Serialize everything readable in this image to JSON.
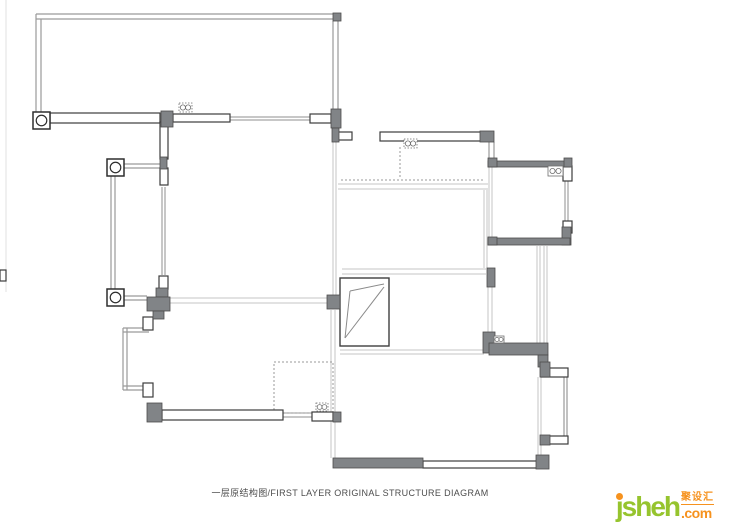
{
  "title": {
    "text": "一层原结构图/FIRST LAYER ORIGINAL STRUCTURE DIAGRAM"
  },
  "logo": {
    "main": "jsheh",
    "cn": "聚设汇",
    "com": ".com",
    "green": "#96c42e",
    "orange": "#f6921e"
  },
  "plan": {
    "colors": {
      "wall_line": "#9a9a9a",
      "glazing": "#8f8f8f",
      "light_line": "#c4c4c4",
      "dotted": "#9a9a9a",
      "artifact": "#e0e0e0",
      "white_fill": "#ffffff",
      "white_stroke": "#3c3c3c",
      "dark_fill": "#818487",
      "dark_stroke": "#4c4c4c",
      "symbol_stroke": "#6f6f6f",
      "column_stroke": "#2e2e2e",
      "stair_stroke": "#3f3f3f",
      "stair_line": "#8a8a8a"
    },
    "line_groups": [
      {
        "name": "structural-wall-line",
        "color": "wall_line",
        "width": 1.2,
        "segments": [
          [
            36,
            14,
            339,
            14
          ],
          [
            36,
            19,
            339,
            19
          ],
          [
            36,
            14,
            36,
            113
          ],
          [
            41,
            19,
            41,
            113
          ],
          [
            333,
            21,
            333,
            110
          ],
          [
            338,
            21,
            338,
            110
          ],
          [
            124,
            164,
            160,
            164
          ],
          [
            124,
            168,
            160,
            168
          ],
          [
            111,
            176,
            111,
            289
          ],
          [
            115,
            176,
            115,
            289
          ],
          [
            124,
            296,
            147,
            296
          ],
          [
            124,
            300,
            147,
            300
          ],
          [
            123,
            328,
            123,
            390
          ],
          [
            127,
            328,
            127,
            390
          ],
          [
            123,
            328,
            149,
            328
          ],
          [
            123,
            332,
            149,
            332
          ],
          [
            123,
            386,
            149,
            386
          ],
          [
            123,
            390,
            149,
            390
          ],
          [
            489,
            142,
            489,
            158
          ],
          [
            494,
            142,
            494,
            158
          ],
          [
            564,
            377,
            564,
            436
          ],
          [
            567,
            377,
            567,
            436
          ]
        ]
      },
      {
        "name": "window-glazing-line",
        "color": "glazing",
        "width": 1,
        "segments": [
          [
            230,
            117,
            310,
            117
          ],
          [
            230,
            120,
            310,
            120
          ],
          [
            162,
            187,
            162,
            275
          ],
          [
            165,
            187,
            165,
            275
          ],
          [
            283,
            413,
            312,
            413
          ],
          [
            283,
            417,
            312,
            417
          ],
          [
            565,
            181,
            565,
            222
          ],
          [
            568,
            181,
            568,
            222
          ]
        ]
      },
      {
        "name": "interior-wall-line",
        "color": "light_line",
        "width": 1,
        "segments": [
          [
            170,
            298,
            327,
            298
          ],
          [
            170,
            303,
            327,
            303
          ],
          [
            333,
            142,
            333,
            296
          ],
          [
            336,
            142,
            336,
            296
          ],
          [
            338,
            184,
            488,
            184
          ],
          [
            338,
            189,
            488,
            189
          ],
          [
            342,
            269,
            486,
            269
          ],
          [
            342,
            274,
            486,
            274
          ],
          [
            340,
            350,
            484,
            350
          ],
          [
            340,
            354,
            484,
            354
          ],
          [
            484,
            190,
            484,
            268
          ],
          [
            487,
            190,
            487,
            268
          ],
          [
            489,
            167,
            489,
            237
          ],
          [
            492,
            167,
            492,
            237
          ],
          [
            488,
            287,
            488,
            332
          ],
          [
            492,
            287,
            492,
            332
          ],
          [
            331,
            310,
            331,
            458
          ],
          [
            335,
            310,
            335,
            458
          ],
          [
            538,
            377,
            538,
            457
          ],
          [
            541,
            377,
            541,
            457
          ],
          [
            537,
            246,
            537,
            344
          ],
          [
            540,
            246,
            540,
            344
          ],
          [
            544,
            246,
            544,
            344
          ],
          [
            547,
            246,
            547,
            344
          ]
        ]
      },
      {
        "name": "hidden-dotted-line",
        "color": "dotted",
        "width": 1,
        "dash": "2,2",
        "segments": [
          [
            400,
            147,
            400,
            179
          ],
          [
            341,
            180,
            483,
            180
          ]
        ]
      },
      {
        "name": "border-artifact-line",
        "color": "artifact",
        "width": 1,
        "segments": [
          [
            6,
            0,
            6,
            292
          ]
        ]
      }
    ],
    "dotted_rects": [
      [
        274,
        362,
        59,
        51
      ]
    ],
    "stair": {
      "rect": [
        340,
        278,
        49,
        68
      ],
      "lines": [
        [
          345,
          338,
          350,
          291
        ],
        [
          350,
          291,
          384,
          284
        ],
        [
          345,
          338,
          384,
          287
        ]
      ]
    },
    "rect_groups": [
      {
        "name": "window-wall-segment",
        "fill": "white_fill",
        "stroke": "white_stroke",
        "stroke_width": 1.2,
        "rects": [
          [
            50,
            113,
            110,
            10
          ],
          [
            173,
            114,
            57,
            8
          ],
          [
            310,
            114,
            21,
            9
          ],
          [
            338,
            132,
            14,
            8
          ],
          [
            380,
            132,
            103,
            9
          ],
          [
            160,
            122,
            8,
            37
          ],
          [
            160,
            168,
            8,
            17
          ],
          [
            159,
            276,
            9,
            13
          ],
          [
            143,
            317,
            10,
            13
          ],
          [
            143,
            383,
            10,
            14
          ],
          [
            162,
            410,
            121,
            10
          ],
          [
            312,
            412,
            21,
            9
          ],
          [
            423,
            461,
            117,
            7
          ],
          [
            541,
            368,
            27,
            9
          ],
          [
            541,
            436,
            27,
            8
          ],
          [
            563,
            166,
            9,
            15
          ],
          [
            563,
            221,
            9,
            12
          ],
          [
            0,
            270,
            6,
            11
          ]
        ]
      },
      {
        "name": "concrete-column",
        "fill": "dark_fill",
        "stroke": "dark_stroke",
        "stroke_width": 0.8,
        "rects": [
          [
            161,
            111,
            12,
            16
          ],
          [
            333,
            13,
            8,
            8
          ],
          [
            331,
            109,
            10,
            19
          ],
          [
            332,
            128,
            7,
            14
          ],
          [
            160,
            157,
            7,
            12
          ],
          [
            480,
            131,
            14,
            11
          ],
          [
            488,
            161,
            82,
            6
          ],
          [
            488,
            158,
            9,
            9
          ],
          [
            564,
            158,
            8,
            9
          ],
          [
            562,
            227,
            9,
            18
          ],
          [
            488,
            238,
            82,
            7
          ],
          [
            488,
            237,
            9,
            8
          ],
          [
            487,
            268,
            8,
            19
          ],
          [
            483,
            332,
            12,
            21
          ],
          [
            489,
            343,
            59,
            12
          ],
          [
            538,
            355,
            10,
            12
          ],
          [
            540,
            362,
            10,
            15
          ],
          [
            540,
            435,
            10,
            10
          ],
          [
            536,
            455,
            13,
            14
          ],
          [
            333,
            458,
            90,
            10
          ],
          [
            333,
            412,
            8,
            10
          ],
          [
            147,
            403,
            15,
            19
          ],
          [
            156,
            288,
            12,
            9
          ],
          [
            147,
            297,
            23,
            14
          ],
          [
            153,
            311,
            11,
            8
          ],
          [
            327,
            295,
            13,
            14
          ]
        ]
      }
    ],
    "circle_columns": {
      "size": 17,
      "positions": [
        [
          33,
          112
        ],
        [
          107,
          159
        ],
        [
          107,
          289
        ]
      ]
    },
    "oo_symbols": [
      {
        "x": 179,
        "y": 103,
        "w": 13,
        "h": 9,
        "style": "dotted"
      },
      {
        "x": 404,
        "y": 139,
        "w": 13,
        "h": 9,
        "style": "dotted"
      },
      {
        "x": 548,
        "y": 166,
        "w": 15,
        "h": 10,
        "style": "solid"
      },
      {
        "x": 494,
        "y": 336,
        "w": 10,
        "h": 7,
        "style": "solid"
      },
      {
        "x": 316,
        "y": 403,
        "w": 12,
        "h": 8,
        "style": "dotted"
      }
    ]
  }
}
